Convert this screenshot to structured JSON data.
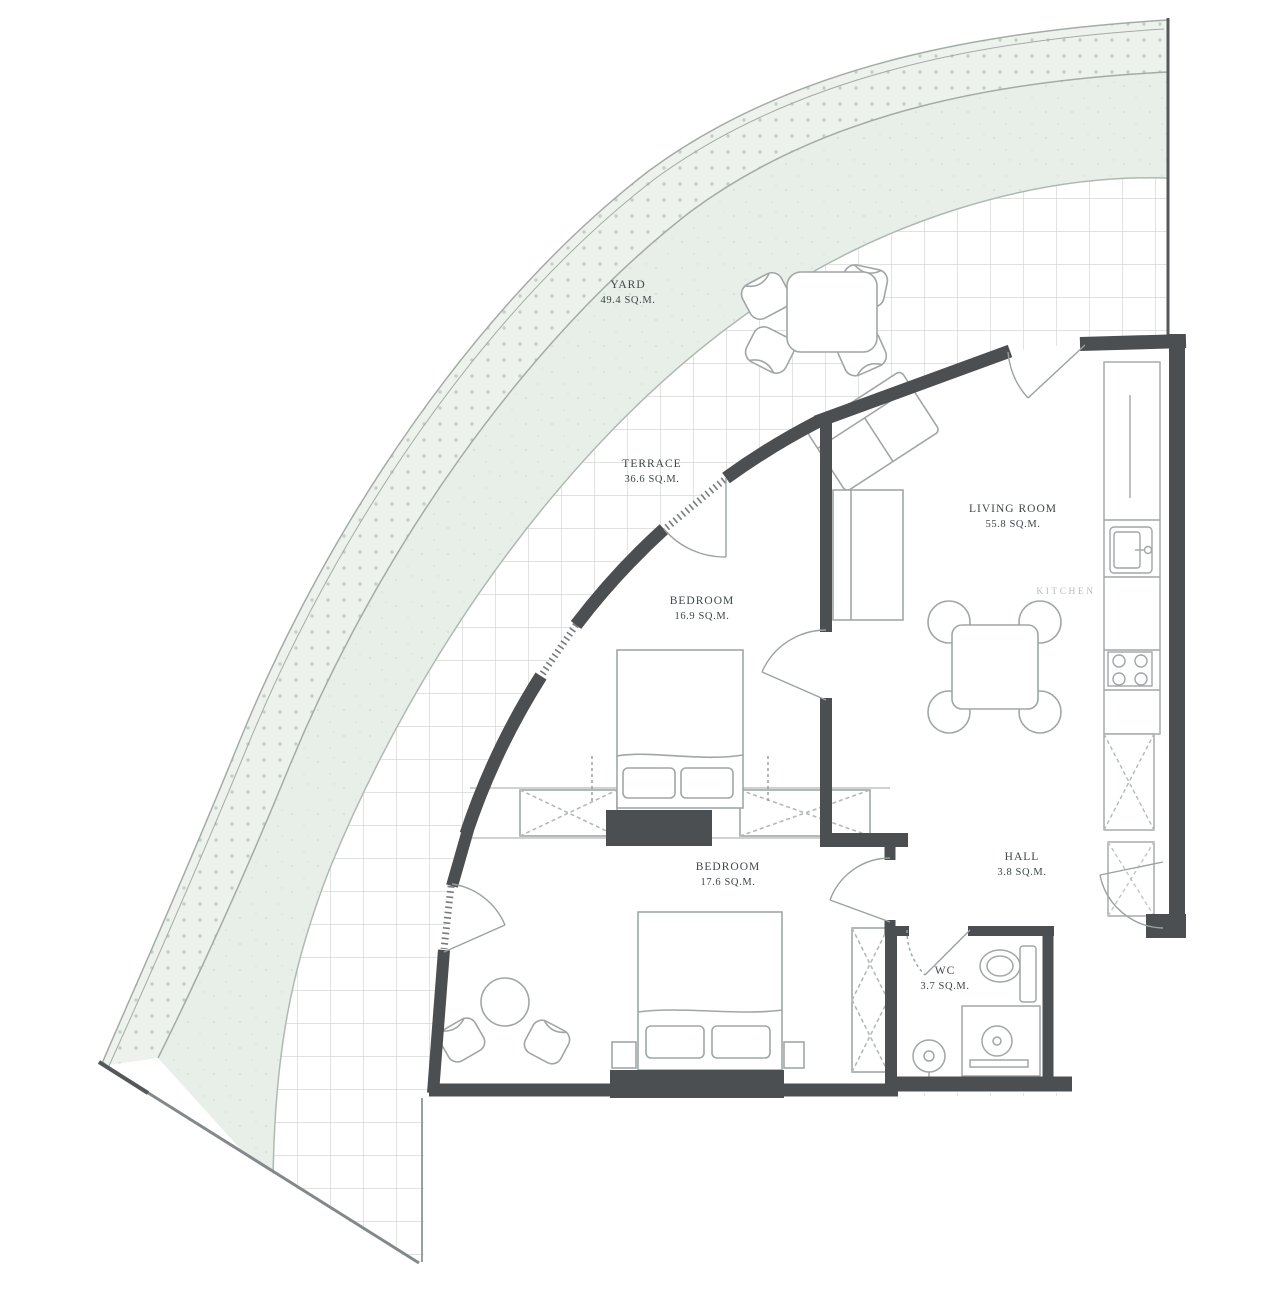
{
  "rooms": {
    "yard": {
      "name": "YARD",
      "area": "49.4 SQ.M."
    },
    "terrace": {
      "name": "TERRACE",
      "area": "36.6 SQ.M."
    },
    "living_room": {
      "name": "LIVING ROOM",
      "area": "55.8 SQ.M."
    },
    "bedroom_upper": {
      "name": "BEDROOM",
      "area": "16.9 SQ.M."
    },
    "bedroom_lower": {
      "name": "BEDROOM",
      "area": "17.6 SQ.M."
    },
    "hall": {
      "name": "HALL",
      "area": "3.8 SQ.M."
    },
    "wc": {
      "name": "WC",
      "area": "3.7 SQ.M."
    },
    "kitchen": {
      "name": "KITCHEN"
    }
  },
  "colors": {
    "wall": "#4b4f51",
    "band_dotted_fill": "#edf2ed",
    "band_dot": "#c4d1c6",
    "band_solid_fill": "#e7efe8",
    "grid_line": "#ccd1cc",
    "furniture_line": "#9aa1a1",
    "label_text": "#3f4648",
    "kitchen_label": "#b6bdbd"
  }
}
